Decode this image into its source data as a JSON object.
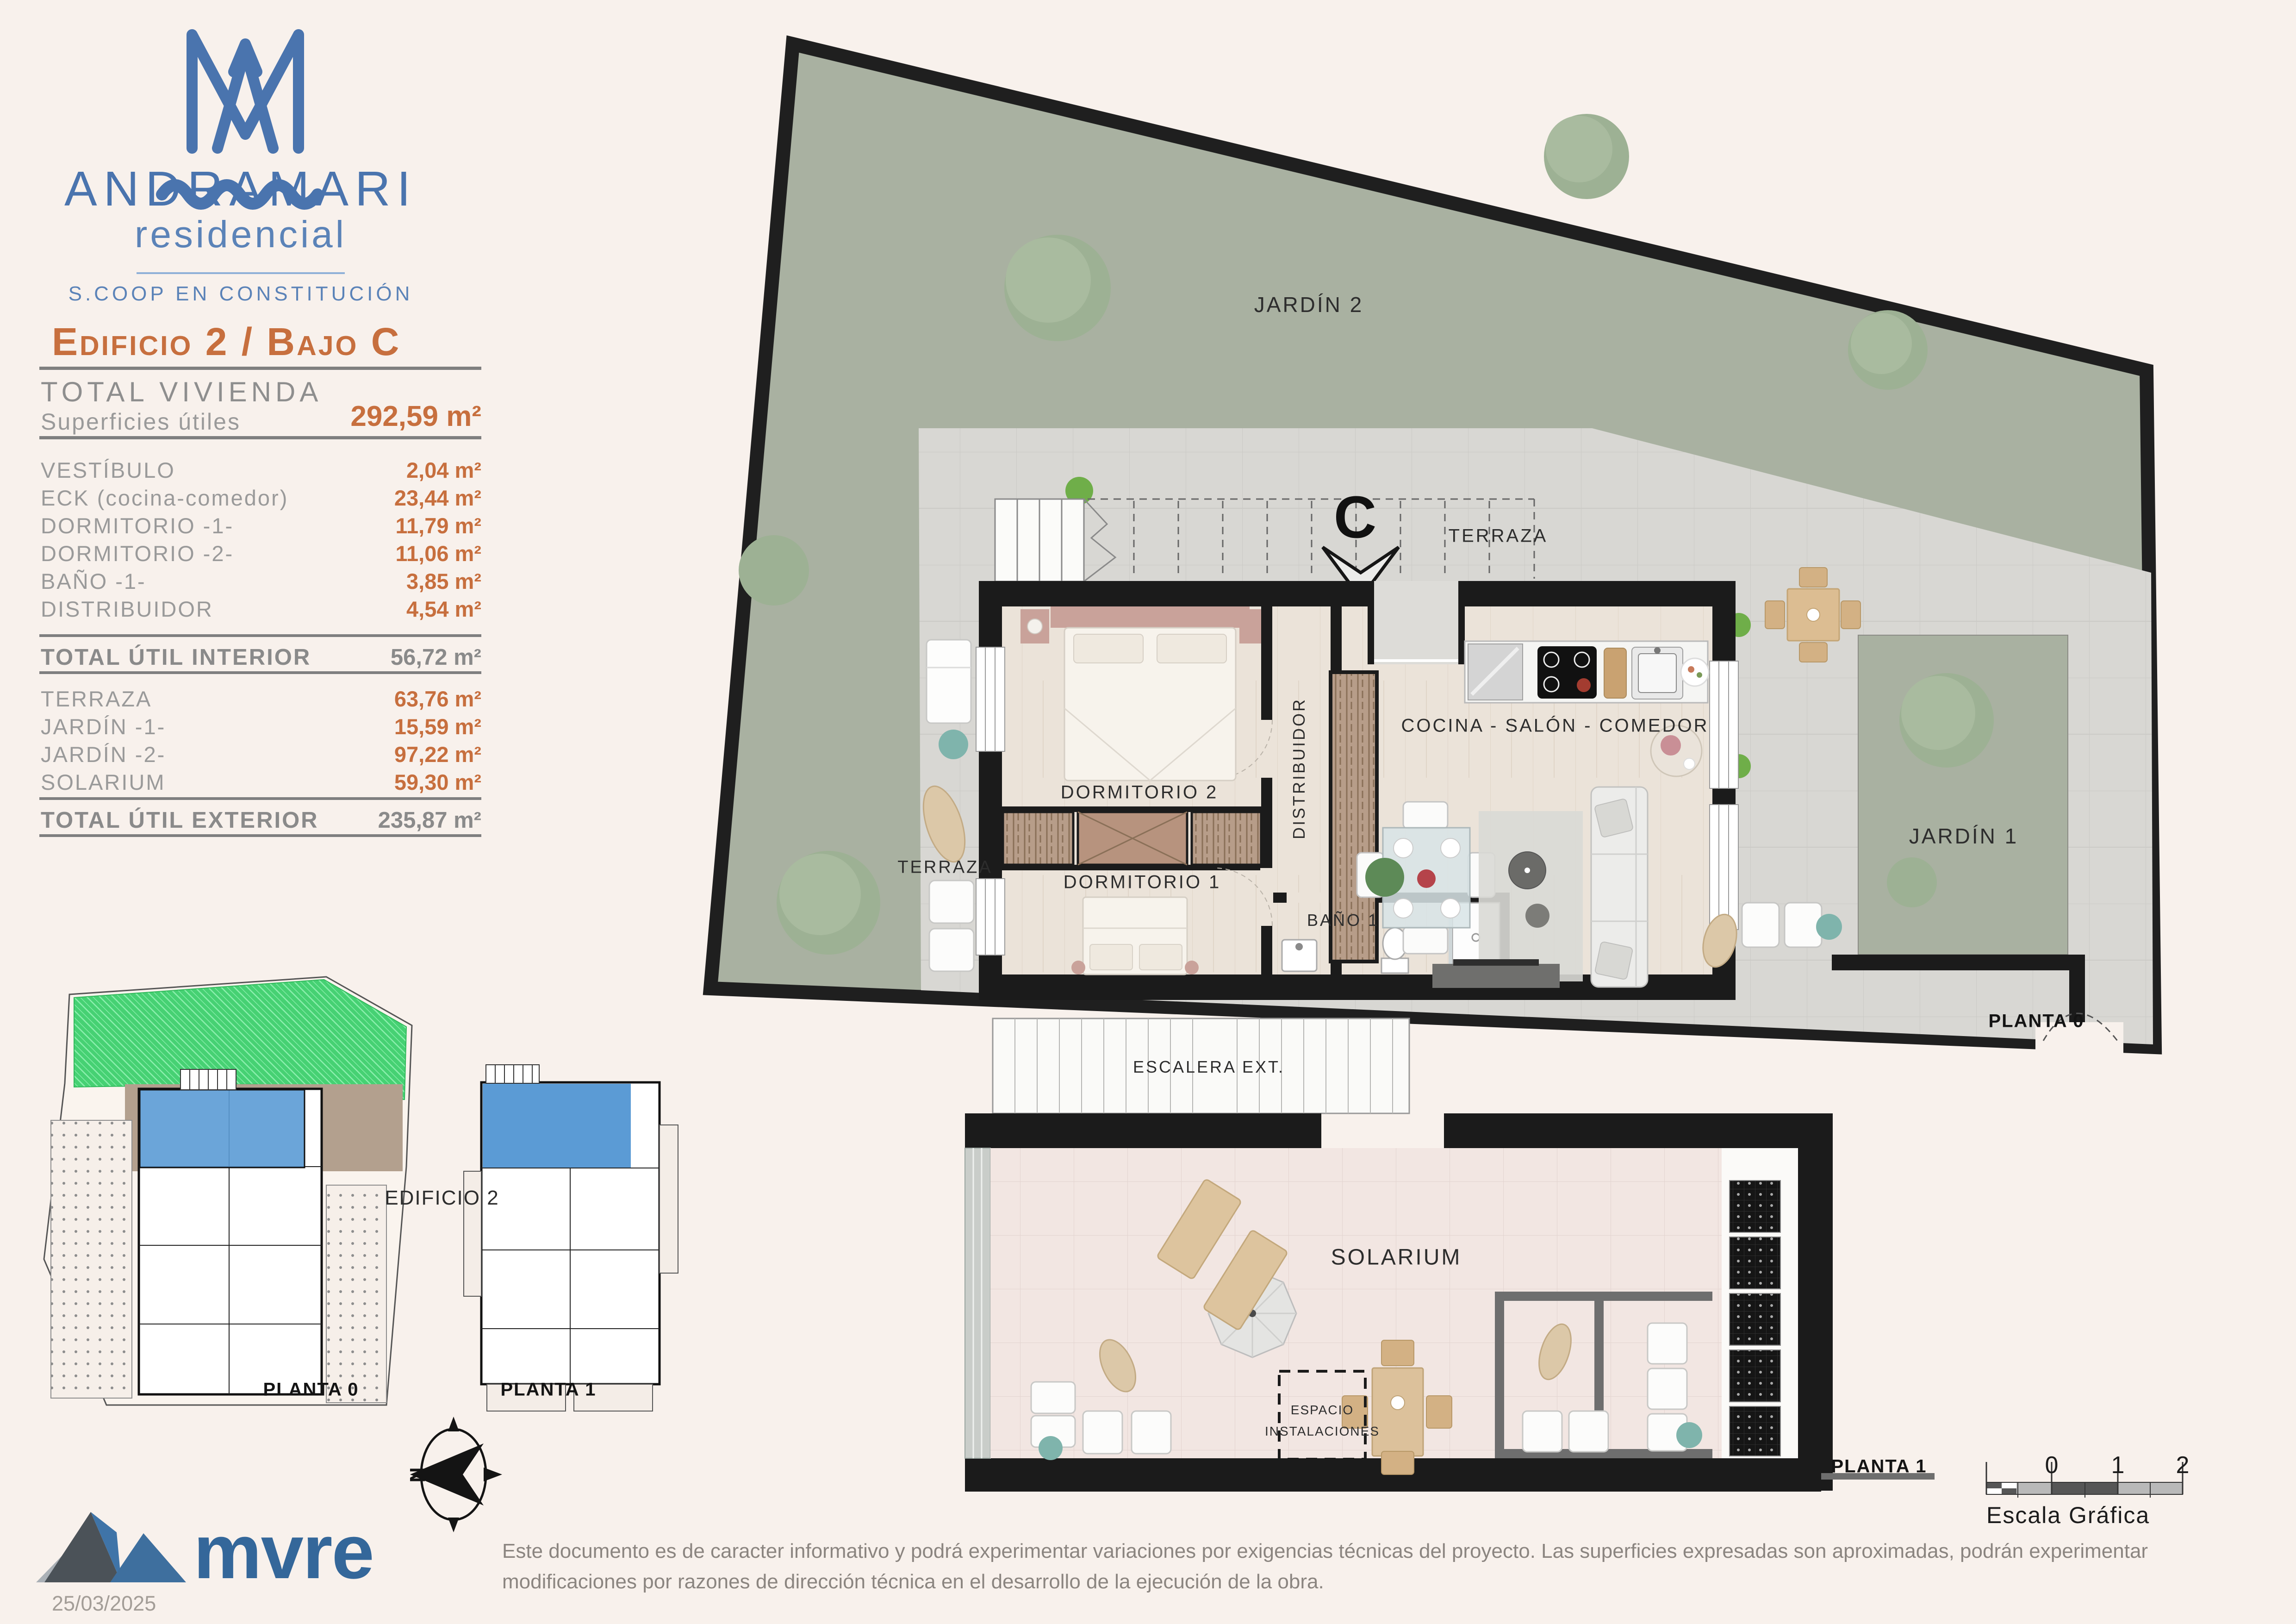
{
  "brand": {
    "name": "ANDRAMARI",
    "tagline": "residencial",
    "coop": "S.COOP EN CONSTITUCIÓN",
    "logo_icon": "am-monogram-wave-icon"
  },
  "unit_header": {
    "title": "Edificio 2 / Bajo C"
  },
  "summary": {
    "title": "TOTAL VIVIENDA",
    "subtitle": "Superficies útiles",
    "total_value": "292,59 m²"
  },
  "interior_rows": [
    {
      "label": "VESTÍBULO",
      "value": "2,04 m²"
    },
    {
      "label": "ECK (cocina-comedor)",
      "value": "23,44 m²"
    },
    {
      "label": "DORMITORIO -1-",
      "value": "11,79 m²"
    },
    {
      "label": "DORMITORIO -2-",
      "value": "11,06 m²"
    },
    {
      "label": "BAÑO -1-",
      "value": "3,85 m²"
    },
    {
      "label": "DISTRIBUIDOR",
      "value": "4,54 m²"
    }
  ],
  "interior_total": {
    "label": "TOTAL ÚTIL INTERIOR",
    "value": "56,72 m²"
  },
  "exterior_rows": [
    {
      "label": "TERRAZA",
      "value": "63,76 m²"
    },
    {
      "label": "JARDÍN -1-",
      "value": "15,59 m²"
    },
    {
      "label": "JARDÍN -2-",
      "value": "97,22 m²"
    },
    {
      "label": "SOLARIUM",
      "value": "59,30 m²"
    }
  ],
  "exterior_total": {
    "label": "TOTAL ÚTIL EXTERIOR",
    "value": "235,87 m²"
  },
  "plan0": {
    "jardin2": "JARDÍN 2",
    "terraza_top": "TERRAZA",
    "terraza_left": "TERRAZA",
    "dormitorio2": "DORMITORIO 2",
    "dormitorio1": "DORMITORIO 1",
    "distribuidor": "DISTRIBUIDOR",
    "bano1": "BAÑO 1",
    "cocina": "COCINA - SALÓN - COMEDOR",
    "jardin1": "JARDÍN 1",
    "floor_label": "PLANTA 0",
    "unit_marker": "C"
  },
  "plan1": {
    "escalera": "ESCALERA EXT.",
    "solarium": "SOLARIUM",
    "espacio_line1": "ESPACIO",
    "espacio_line2": "INSTALACIONES",
    "floor_label": "PLANTA 1"
  },
  "site_plans": {
    "edificio": "EDIFICIO 2",
    "planta0": "PLANTA 0",
    "planta1": "PLANTA 1"
  },
  "compass": {
    "north": "N"
  },
  "scale_bar": {
    "ticks": [
      "0",
      "1",
      "2"
    ],
    "caption": "Escala Gráfica"
  },
  "footer": {
    "logo_text": "mvre",
    "date": "25/03/2025",
    "disclaimer": "Este documento es de caracter informativo y podrá experimentar variaciones por exigencias técnicas del proyecto. Las superficies expresadas son aproximadas, podrán experimentar modificaciones por razones de dirección técnica en el desarrollo de la ejecución de la obra."
  },
  "colors": {
    "accent_orange": "#c76f3e",
    "brand_blue": "#4a74ae",
    "grass_green": "#a9b1a1",
    "terrace_gray": "#d8d7d3",
    "solarium_pink": "#f2e6e2",
    "wall_black": "#1b1b1b",
    "mini_green": "#46d173",
    "mini_blue": "#5b9bd5"
  }
}
